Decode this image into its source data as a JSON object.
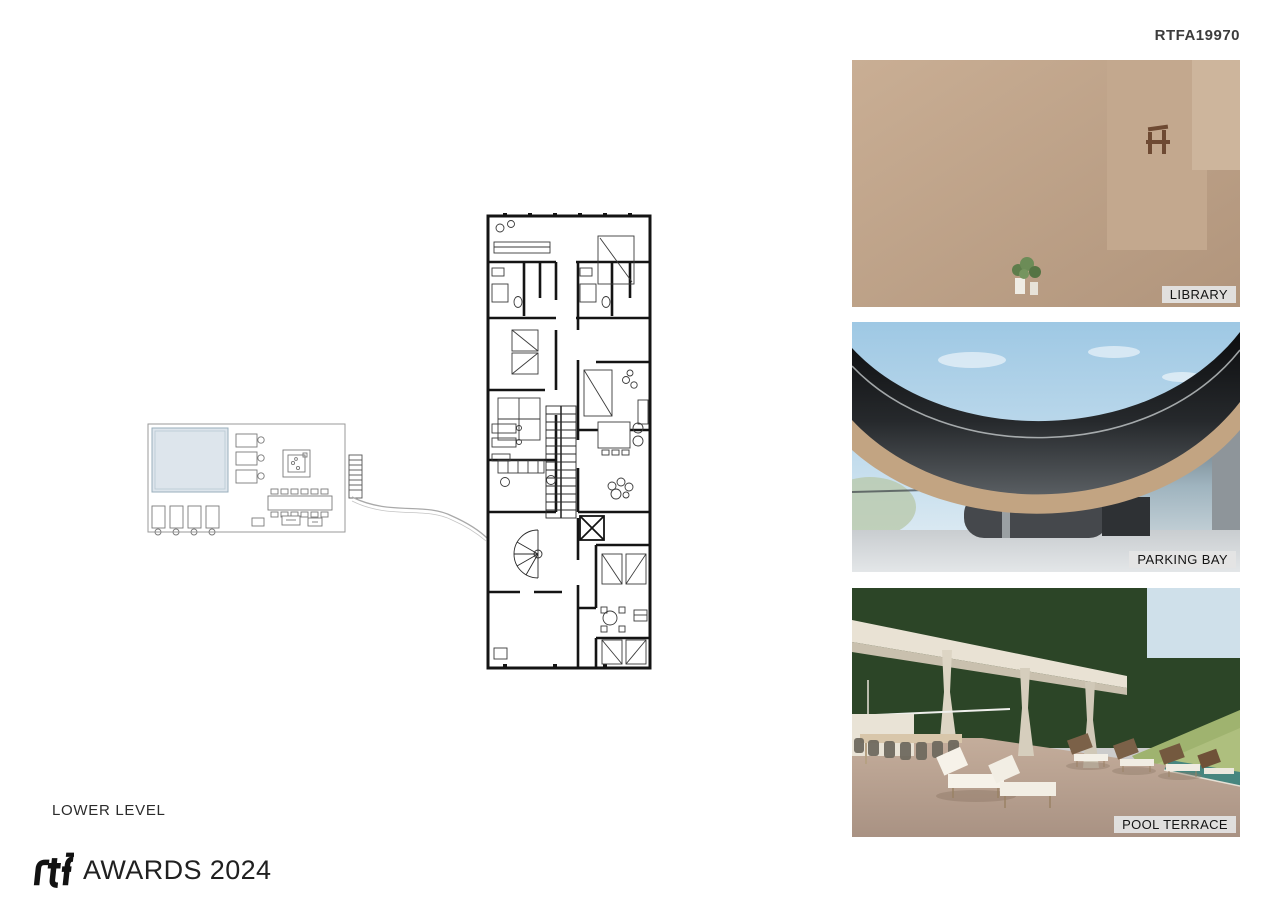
{
  "header": {
    "code": "RTFA19970"
  },
  "plan": {
    "level_label": "LOWER LEVEL",
    "room_labels": [
      {
        "name": "master-bedroom",
        "label": "MASTER BEDROOM",
        "x": 568,
        "y": 231
      },
      {
        "name": "bedroom-2",
        "label": "BEDROOM 2",
        "x": 528,
        "y": 373
      },
      {
        "name": "bedroom-3",
        "label": "BEDROOM 3",
        "x": 616,
        "y": 353
      },
      {
        "name": "gym",
        "label": "GYM",
        "x": 527,
        "y": 437
      },
      {
        "name": "studio",
        "label": "STUDIO",
        "x": 616,
        "y": 462
      },
      {
        "name": "family-room",
        "label": "FAMILY R.",
        "x": 521,
        "y": 503
      },
      {
        "name": "music-room",
        "label": "MUSIC R.",
        "x": 613,
        "y": 503
      },
      {
        "name": "service-room",
        "label": "SERVICE R.",
        "x": 612,
        "y": 596
      },
      {
        "name": "machine-room",
        "label": "MACHINE R.",
        "x": 535,
        "y": 626
      },
      {
        "name": "pool-terrace",
        "label": "POOL TERRACE",
        "x": 293,
        "y": 490
      }
    ],
    "trees": [
      [
        163,
        248,
        58,
        "#d3d9d0",
        "#c4cdc1",
        0.5,
        0
      ],
      [
        352,
        298,
        40,
        "#d3d9d0",
        "#c4cdc1",
        0.5,
        0
      ],
      [
        247,
        357,
        44,
        "#cfd6cb",
        "#c0c9bc",
        0.5,
        0
      ],
      [
        105,
        420,
        40,
        "#cdd5c8",
        "#bec8b9",
        0.55,
        0
      ],
      [
        63,
        520,
        36,
        "#cdd5c8",
        "#bec8b9",
        0.55,
        0
      ],
      [
        395,
        178,
        48,
        "#c8d1c2",
        "#b9c4b2",
        0.55,
        0
      ],
      [
        700,
        148,
        46,
        "#d3d9d0",
        "#c4cdc1",
        0.5,
        0
      ],
      [
        788,
        200,
        50,
        "#cfd6cb",
        "#c0c9bc",
        0.5,
        0
      ],
      [
        812,
        332,
        42,
        "#cdd5c8",
        "#bec8b9",
        0.55,
        0
      ],
      [
        772,
        395,
        44,
        "#cdd5c8",
        "#bec8b9",
        0.5,
        0
      ],
      [
        400,
        548,
        44,
        "#d0d7cc",
        "#c1cabd",
        0.55,
        1
      ],
      [
        302,
        560,
        46,
        "#cdd5c8",
        "#bec8b9",
        0.55,
        1
      ],
      [
        424,
        585,
        38,
        "#cdd5c8",
        "#bec8b9",
        0.55,
        0
      ],
      [
        757,
        557,
        40,
        "#cfd6cb",
        "#c0c9bc",
        0.5,
        0
      ],
      [
        792,
        645,
        36,
        "#cdd5c8",
        "#bec8b9",
        0.5,
        0
      ],
      [
        737,
        723,
        34,
        "#cfd6cb",
        "#c0c9bc",
        0.5,
        0
      ],
      [
        645,
        768,
        34,
        "#cdd5c8",
        "#bec8b9",
        0.55,
        0
      ],
      [
        553,
        748,
        38,
        "#c8d1c2",
        "#b9c4b2",
        0.55,
        0
      ],
      [
        533,
        132,
        48,
        "#64805c",
        "#4a6344",
        1,
        0
      ],
      [
        470,
        176,
        36,
        "#7d9373",
        "#5d7a55",
        1,
        0
      ],
      [
        627,
        142,
        40,
        "#95a98c",
        "#7b9370",
        1,
        0
      ],
      [
        425,
        215,
        24,
        "#7b9370",
        "#5f7a55",
        0.9,
        0
      ],
      [
        455,
        283,
        24,
        "#45603e",
        "#324a2e",
        1,
        0
      ],
      [
        303,
        291,
        26,
        "#6d8964",
        "#53704b",
        1,
        0
      ],
      [
        381,
        276,
        28,
        "#7f9775",
        "#64805c",
        1,
        0
      ],
      [
        668,
        247,
        30,
        "#75906b",
        "#5a7751",
        0.92,
        1
      ],
      [
        733,
        247,
        33,
        "#97ab8e",
        "#7b9370",
        1,
        0
      ],
      [
        663,
        342,
        24,
        "#8aa182",
        "#6e8865",
        0.92,
        1
      ],
      [
        461,
        352,
        19,
        "#55714d",
        "#3f5a39",
        1,
        0
      ],
      [
        226,
        426,
        30,
        "#75916c",
        "#5a7751",
        1,
        0
      ],
      [
        300,
        443,
        26,
        "#8aa483",
        "#6e8865",
        1,
        0
      ],
      [
        448,
        498,
        36,
        "#6e8764",
        "#53704b",
        0.95,
        1
      ],
      [
        92,
        482,
        32,
        "#93a98b",
        "#778e6e",
        1,
        0
      ],
      [
        62,
        576,
        26,
        "#4c663f",
        "#39512f",
        1,
        0
      ],
      [
        95,
        598,
        24,
        "#3d5a36",
        "#2c4427",
        1,
        0
      ],
      [
        203,
        562,
        32,
        "#7e9674",
        "#62805a",
        0.95,
        1
      ],
      [
        355,
        570,
        28,
        "#4a6441",
        "#374f30",
        1,
        0
      ],
      [
        290,
        627,
        36,
        "#627c57",
        "#4a6344",
        1,
        0
      ],
      [
        337,
        660,
        38,
        "#5d7852",
        "#45603e",
        1,
        0
      ],
      [
        470,
        706,
        38,
        "#5f7a52",
        "#47613c",
        1,
        0
      ],
      [
        560,
        737,
        36,
        "#87a07b",
        "#6b8661",
        1,
        0
      ],
      [
        637,
        707,
        30,
        "#3f5c38",
        "#2e462a",
        1,
        0
      ],
      [
        680,
        640,
        24,
        "#8ba385",
        "#6f8a68",
        1,
        0
      ],
      [
        713,
        786,
        28,
        "#9db194",
        "#83987b",
        1,
        0
      ],
      [
        660,
        480,
        26,
        "#7d9573",
        "#62805a",
        0.92,
        1
      ],
      [
        672,
        540,
        28,
        "#90a78a",
        "#748c6c",
        0.92,
        1
      ]
    ]
  },
  "photos": [
    {
      "name": "library",
      "label": "LIBRARY"
    },
    {
      "name": "parking-bay",
      "label": "PARKING BAY"
    },
    {
      "name": "pool-terrace",
      "label": "POOL TERRACE"
    }
  ],
  "footer": {
    "mark": "rtf",
    "awards": "AWARDS 2024"
  },
  "palettes": {
    "books": [
      "#f1ece2",
      "#e7dfd1",
      "#d8cec0",
      "#b33a2e",
      "#212121",
      "#d2b63b",
      "#7d8a96",
      "#8c2f28",
      "#ece7dc",
      "#c9a43c",
      "#f5f2ea",
      "#3c3c3c"
    ],
    "bush_greens": [
      "#4e6f43",
      "#5f814f",
      "#71945d",
      "#3f5e37"
    ],
    "forest_greens": [
      "#2f4a2b",
      "#3f5e35",
      "#567a46",
      "#6d9158",
      "#82a569",
      "#243d20"
    ]
  }
}
